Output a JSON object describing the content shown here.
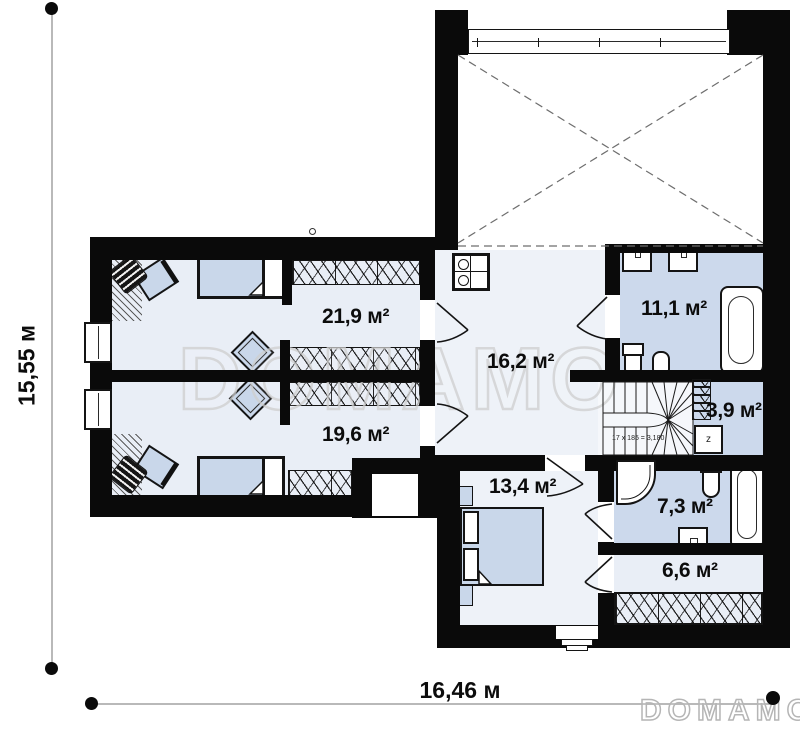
{
  "watermark": {
    "brand_large": "DOMAMO",
    "brand_small": "DOMAMO"
  },
  "dimensions": {
    "height_label": "15,55 м",
    "width_label": "16,46 м"
  },
  "rooms": {
    "bedroom_top": {
      "area": "21,9 м²"
    },
    "bedroom_bottom": {
      "area": "19,6 м²"
    },
    "hall": {
      "area": "16,2 м²"
    },
    "bathroom_main": {
      "area": "11,1 м²"
    },
    "closet": {
      "area": "3,9 м²"
    },
    "bedroom_master": {
      "area": "13,4 м²"
    },
    "bathroom_ensuite": {
      "area": "7,3 м²"
    },
    "wardrobe": {
      "area": "6,6 м²"
    }
  },
  "stairs": {
    "note": "17 x 185 = 3,180"
  },
  "equipment": {
    "boiler_label": "z"
  },
  "colors": {
    "wall": "#0a0a0a",
    "room_light": "#e9eef6",
    "room_blue": "#ccd9ec",
    "furniture": "#c9d7ea",
    "watermark": "#cfcfcf"
  }
}
